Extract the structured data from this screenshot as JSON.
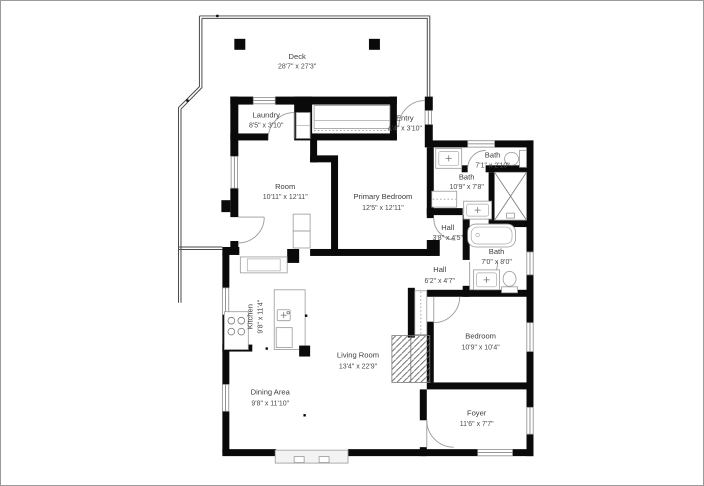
{
  "floor_plan": {
    "rooms": [
      {
        "name": "Deck",
        "dims": "28'7\" x 27'3\""
      },
      {
        "name": "Laundry",
        "dims": "8'5\" x 3'10\""
      },
      {
        "name": "Entry",
        "dims": "4'4\" x 3'10\""
      },
      {
        "name": "Room",
        "dims": "10'11\" x 12'11\""
      },
      {
        "name": "Primary Bedroom",
        "dims": "12'5\" x 12'11\""
      },
      {
        "name": "Bath",
        "dims": "7'1\" x 2'10\""
      },
      {
        "name": "Bath",
        "dims": "10'9\" x 7'8\""
      },
      {
        "name": "Hall",
        "dims": "3'8\" x 4'5\""
      },
      {
        "name": "Bath",
        "dims": "7'0\" x 8'0\""
      },
      {
        "name": "Hall",
        "dims": "6'2\" x 4'7\""
      },
      {
        "name": "Kitchen",
        "dims": "9'8\" x 11'4\""
      },
      {
        "name": "Living Room",
        "dims": "13'4\" x 22'9\""
      },
      {
        "name": "Bedroom",
        "dims": "10'9\" x 10'4\""
      },
      {
        "name": "Dining Area",
        "dims": "9'8\" x 11'10\""
      },
      {
        "name": "Foyer",
        "dims": "11'6\" x 7'7\""
      }
    ],
    "colors": {
      "walls": "#0a0a0a",
      "labels": "#3d3d3d",
      "background": "#ffffff",
      "fixture_outline": "#999999",
      "deck_outline": "#4a4a4a"
    }
  }
}
